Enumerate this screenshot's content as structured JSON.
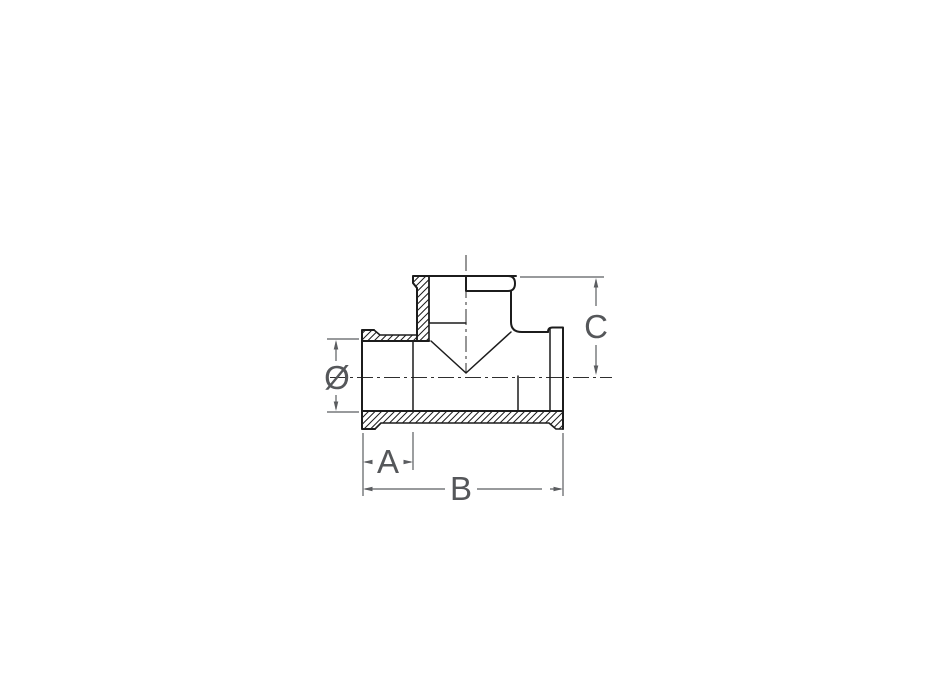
{
  "drawing": {
    "kind": "tee-fitting-half-section",
    "labels": {
      "diameter": "Ø",
      "a": "A",
      "b": "B",
      "c": "C"
    },
    "colors": {
      "background": "#ffffff",
      "outline": "#1c1c1c",
      "dimension": "#5b5d60",
      "label_text": "#55575a"
    }
  }
}
